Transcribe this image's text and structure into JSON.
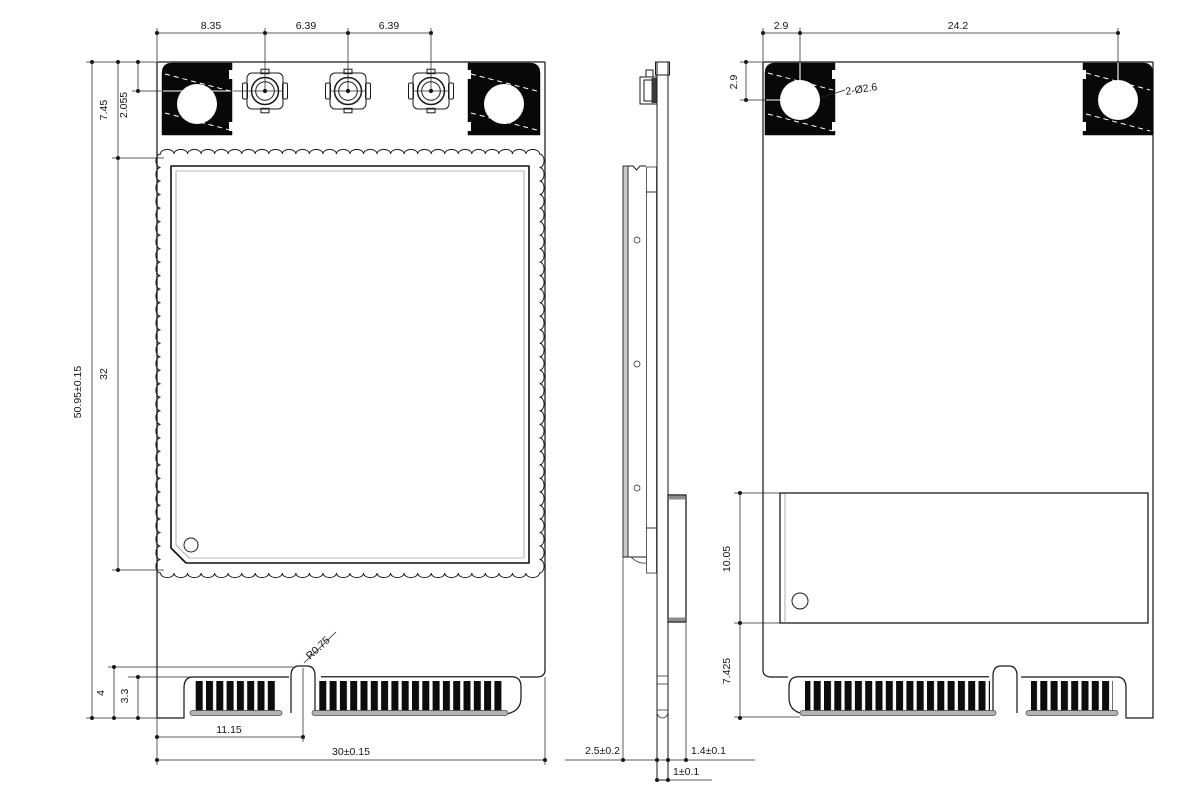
{
  "colors": {
    "line": "#1a1a1a",
    "fill_black": "#080808",
    "gray_baseline": "#b3b3b3",
    "background": "#ffffff"
  },
  "front_view": {
    "dim_ant1_x": "8.35",
    "dim_ant2_x": "6.39",
    "dim_ant3_x": "6.39",
    "dim_shield_top": "7.45",
    "dim_ant_center": "2.055",
    "dim_overall_h": "50.95±0.15",
    "dim_shield_h": "32",
    "dim_edge_h": "4",
    "dim_finger_h": "3.3",
    "dim_key_offset": "11.15",
    "dim_overall_w": "30±0.15",
    "dim_key_radius": "R0.75"
  },
  "side_view": {
    "dim_total_t": "2.5±0.2",
    "dim_back_t": "1.4±0.1",
    "dim_pcb_t": "1±0.1"
  },
  "back_view": {
    "dim_hole_x": "2.9",
    "dim_hole_pitch": "24.2",
    "dim_hole_y": "2.9",
    "dim_hole_d": "2-Ø2.6",
    "dim_comp_h": "10.05",
    "dim_comp_offset": "7.425"
  }
}
